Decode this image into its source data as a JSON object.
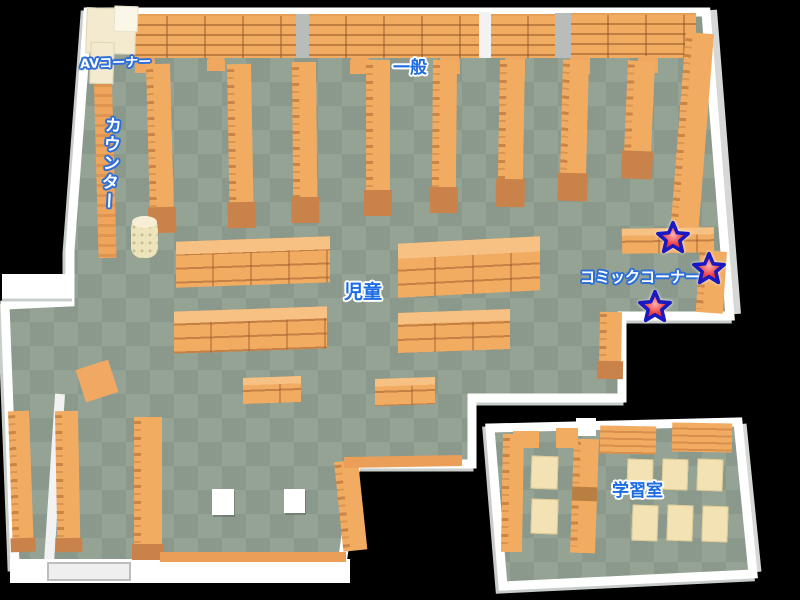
{
  "map": {
    "title": "library-floor-map",
    "labels": {
      "av_corner": "AVコーナー",
      "counter": "カウンター",
      "general": "一般",
      "children": "児童",
      "comic_corner": "コミックコーナー",
      "study_room": "学習室"
    },
    "markers": {
      "star_count": 3,
      "area": "コミックコーナー",
      "fill": "#E8303A",
      "outline": "#1A1AC0"
    },
    "colors": {
      "background": "#000000",
      "floor_dark": "#8A998B",
      "floor_light": "#95A395",
      "wall": "#FFFFFF",
      "wall_shadow": "#C9CDC9",
      "shelf": "#F2AC62",
      "shelf_end": "#C9834A",
      "cabinet_cream": "#F3EAD0",
      "table_cream": "#F3E3B4",
      "label_blue": "#1C6CE4",
      "label_outline_blue": "#2E6FD8"
    }
  }
}
